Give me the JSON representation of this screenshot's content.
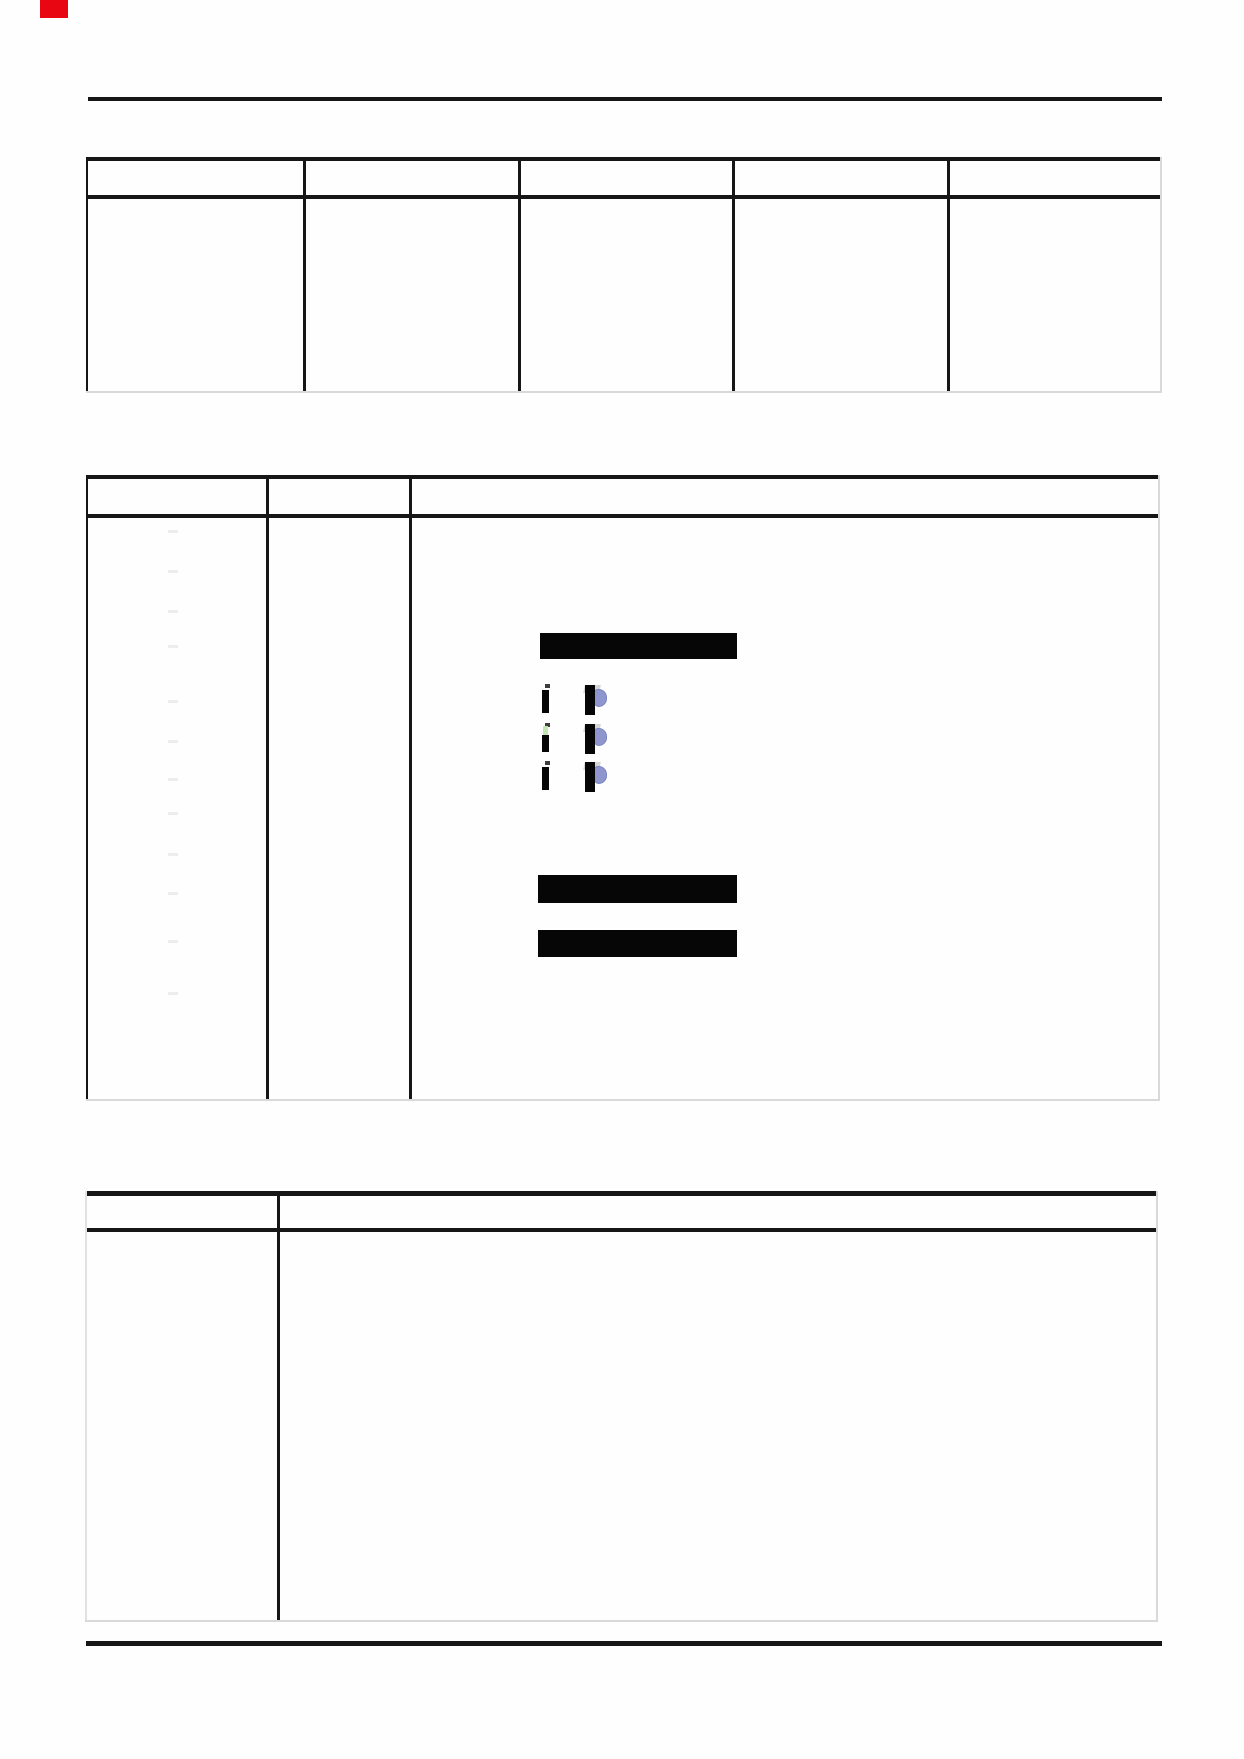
{
  "page": {
    "width": 1244,
    "height": 1759,
    "background": "#fefefe"
  },
  "colors": {
    "line": "#161616",
    "faint_line": "#d9d9d9",
    "light_edge": "#e2e2e2",
    "redaction": "#060606",
    "accent_blue": "#8e96cd",
    "accent_blue_edge": "#7b84c0",
    "accent_green": "#c3e7ae",
    "mark_red": "#e90613",
    "ghost": "#ededed",
    "noise_gray": "#b3b3b3",
    "tick": "#3d3d3d"
  },
  "red_mark": {
    "x": 40,
    "y": 0,
    "width": 28,
    "height": 18
  },
  "rules": [
    {
      "id": "page-top-rule",
      "x": 88,
      "y": 97,
      "width": 1074,
      "height": 4
    },
    {
      "id": "page-bottom-rule",
      "x": 86,
      "y": 1641,
      "width": 1076,
      "height": 5
    }
  ],
  "tables": [
    {
      "id": "table-1",
      "x": 86,
      "y": 157,
      "width": 1076,
      "height": 236,
      "top_border": 4,
      "header_separator_y": 195,
      "header_border": 4,
      "column_separators": [
        303,
        518,
        732,
        947
      ],
      "columns": 5,
      "left_edge": "dark",
      "right_edge": "faint",
      "bottom_edge": "faint"
    },
    {
      "id": "table-2",
      "x": 86,
      "y": 475,
      "width": 1074,
      "height": 626,
      "top_border": 4,
      "header_separator_y": 514,
      "header_border": 4,
      "column_separators": [
        266,
        409
      ],
      "columns": 3,
      "left_edge": "dark",
      "right_edge": "faint",
      "bottom_edge": "faint"
    },
    {
      "id": "table-3",
      "x": 85,
      "y": 1191,
      "width": 1073,
      "height": 431,
      "top_border": 5,
      "header_separator_y": 1228,
      "header_border": 4,
      "column_separators": [
        277
      ],
      "columns": 2,
      "left_edge": "light",
      "right_edge": "faint",
      "bottom_edge": "faint"
    }
  ],
  "redaction_bars": [
    {
      "x": 540,
      "y": 633,
      "width": 197,
      "height": 26
    },
    {
      "x": 538,
      "y": 875,
      "width": 199,
      "height": 28
    },
    {
      "x": 538,
      "y": 930,
      "width": 199,
      "height": 27
    }
  ],
  "glyph_rows": [
    {
      "y": 683,
      "green": false
    },
    {
      "y": 722,
      "green": true
    },
    {
      "y": 760,
      "green": false
    }
  ],
  "ghost_marks": {
    "x": 168,
    "width": 10,
    "height": 3,
    "ys": [
      530,
      570,
      610,
      645,
      700,
      740,
      778,
      812,
      853,
      892,
      940,
      992
    ]
  }
}
